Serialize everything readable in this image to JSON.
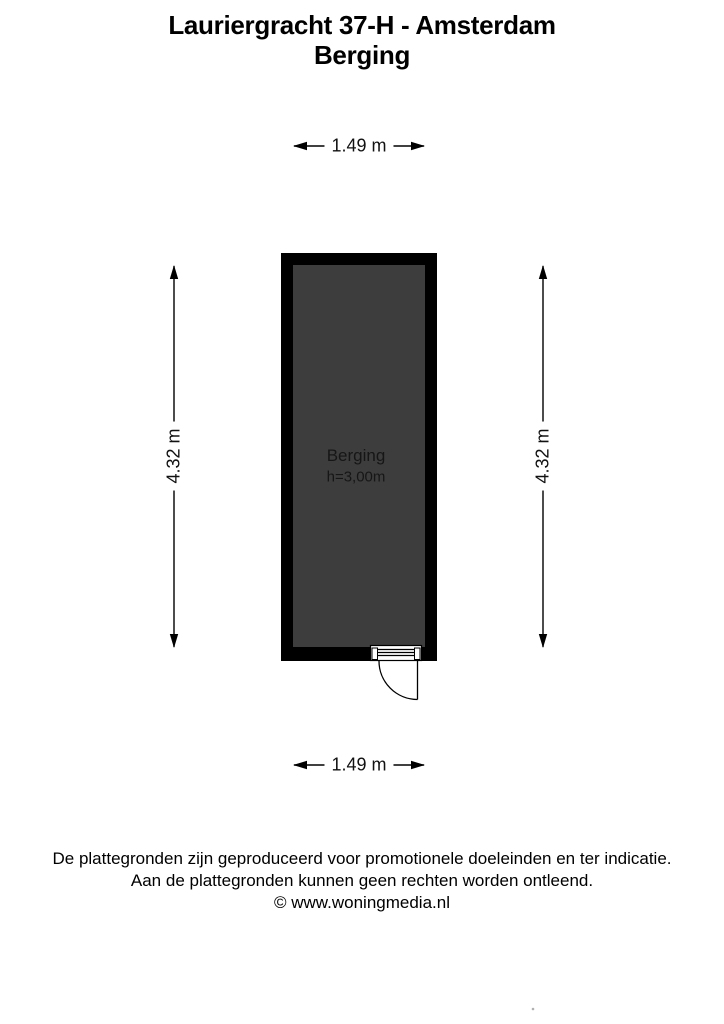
{
  "header": {
    "title": "Lauriergracht 37-H - Amsterdam",
    "subtitle": "Berging"
  },
  "floorplan": {
    "room": {
      "label": "Berging",
      "ceiling_height": "h=3,00m"
    },
    "dimensions": {
      "width_top": "1.49 m",
      "width_bottom": "1.49 m",
      "height_left": "4.32 m",
      "height_right": "4.32 m"
    },
    "colors": {
      "wall": "#000000",
      "floor": "#3d3d3d"
    }
  },
  "footer": {
    "disclaimer_line1": "De plattegronden zijn geproduceerd voor promotionele doeleinden en ter indicatie.",
    "disclaimer_line2": "Aan de plattegronden kunnen geen rechten worden ontleend.",
    "copyright": "© www.woningmedia.nl"
  }
}
